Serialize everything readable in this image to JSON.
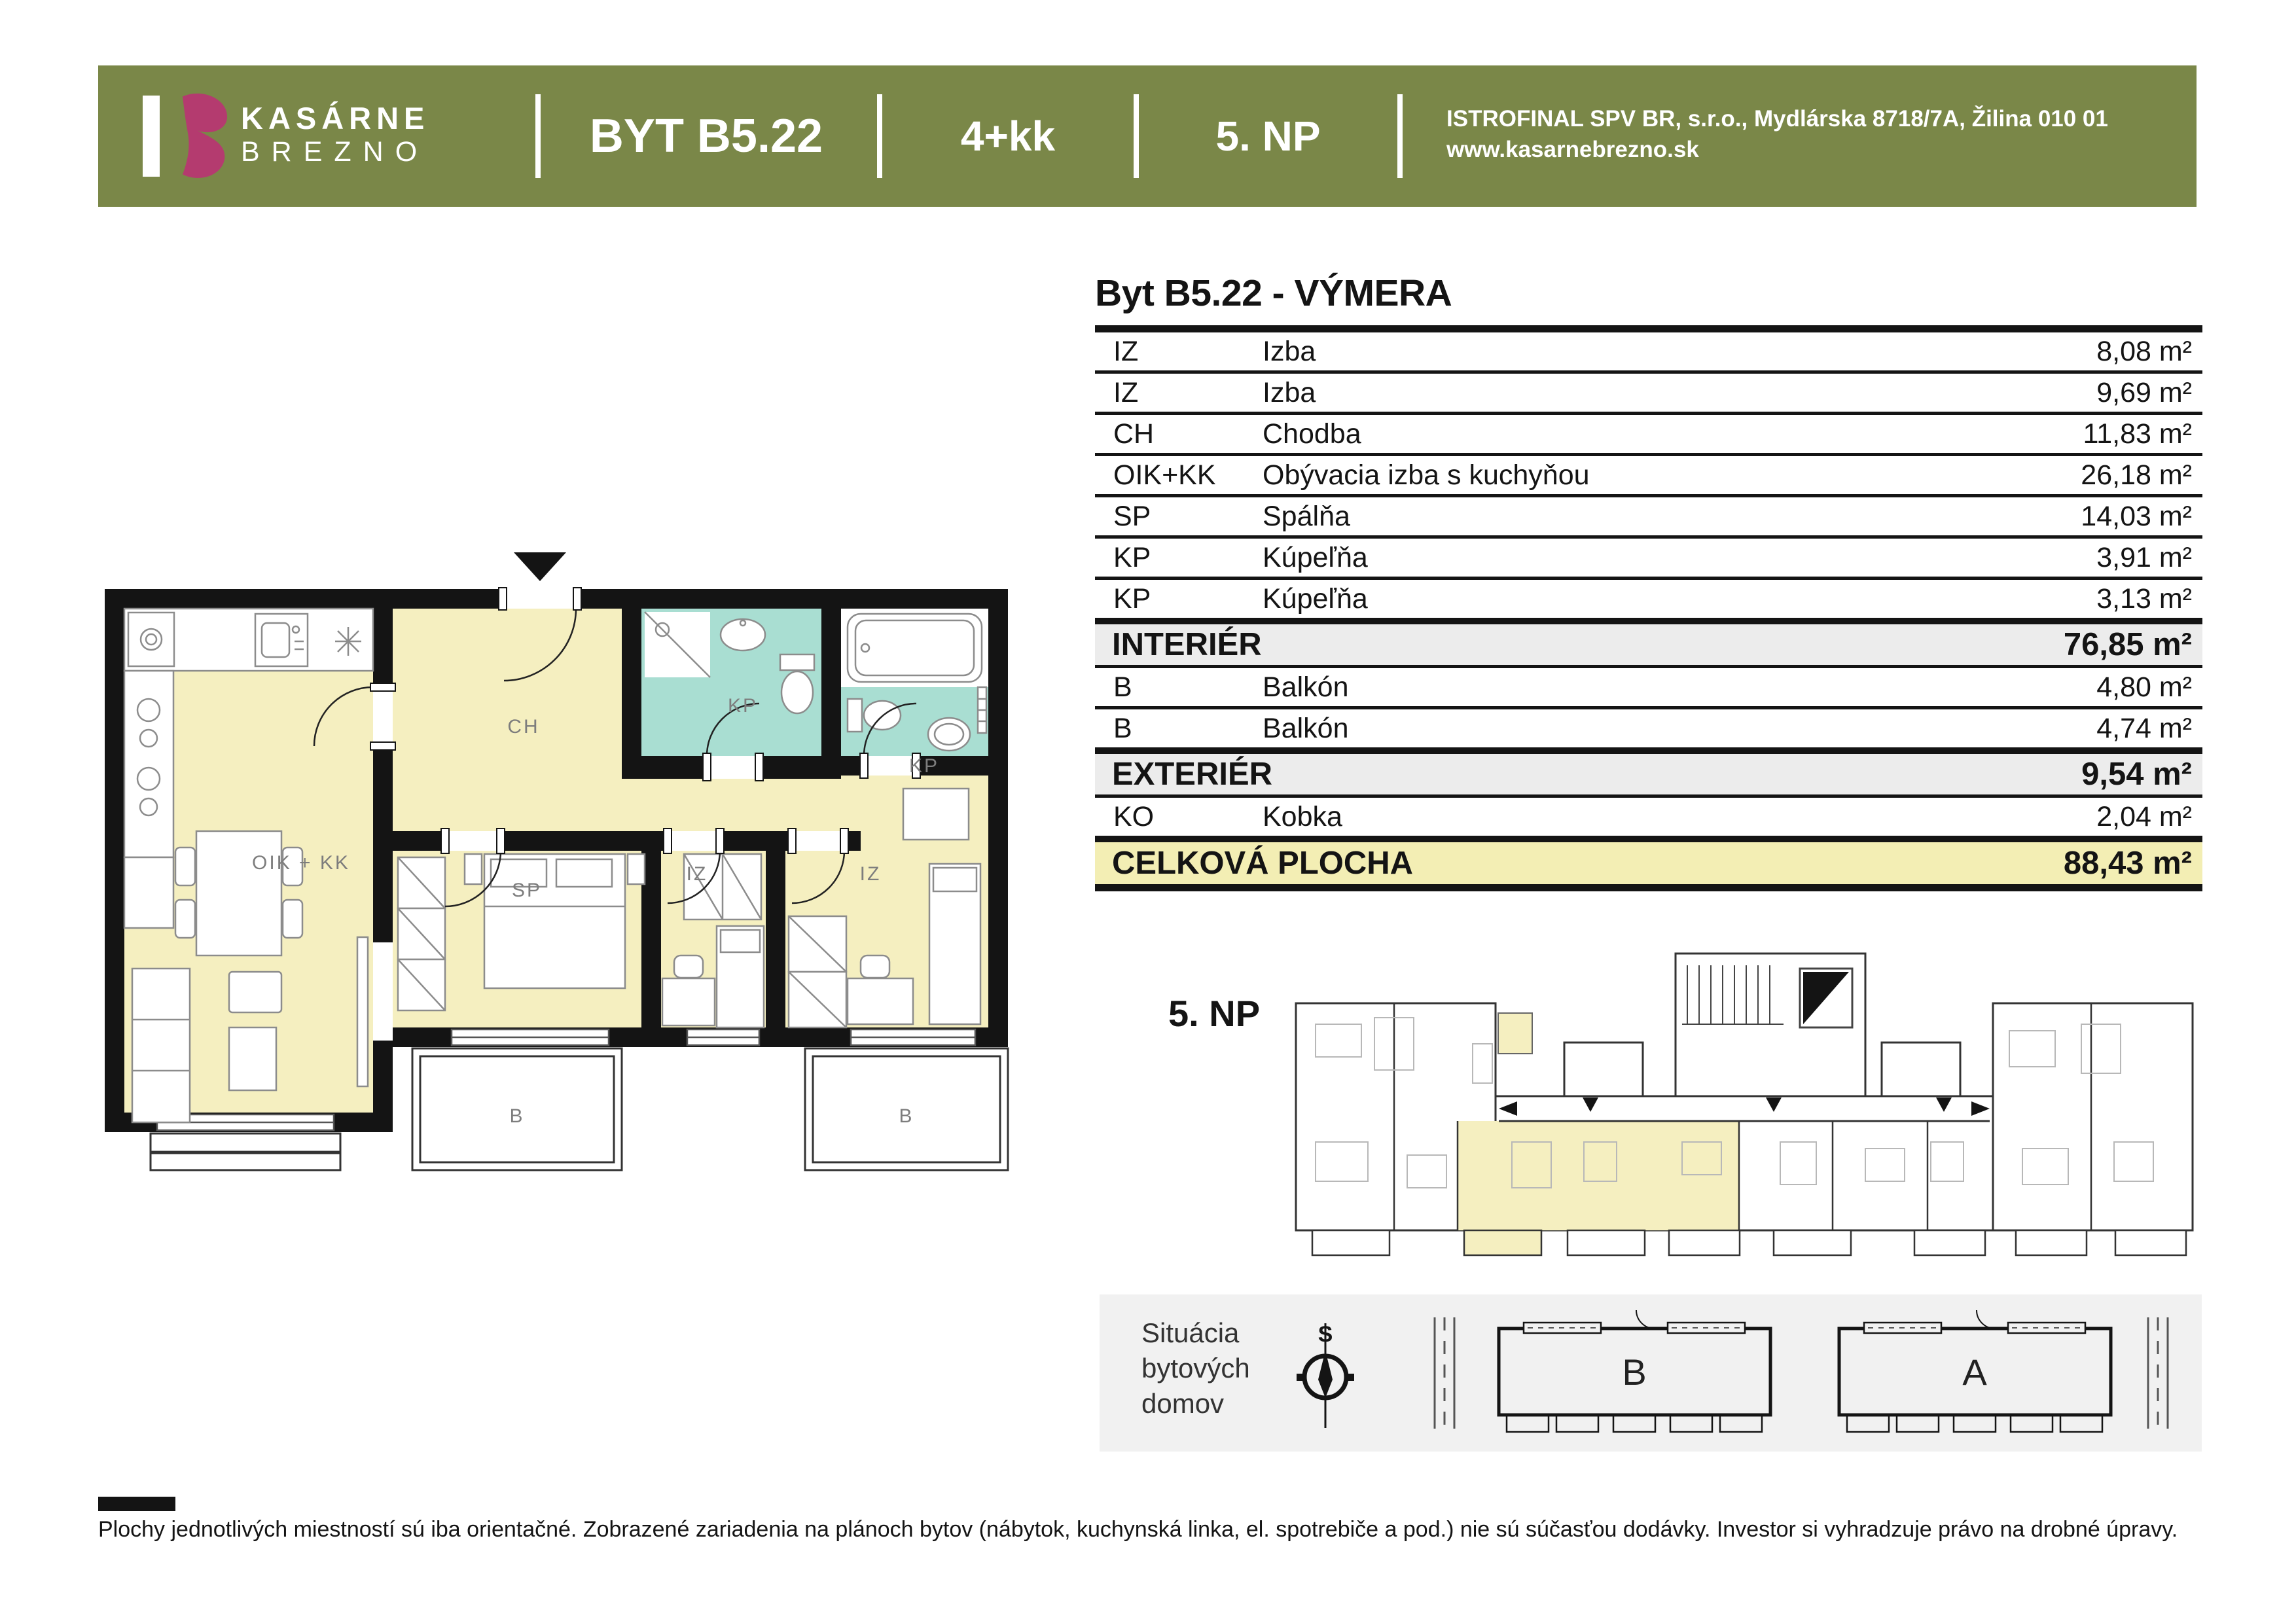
{
  "header": {
    "bar_color": "#7a8748",
    "logo": {
      "brand_top": "KASÁRNE",
      "brand_bottom": "BREZNO",
      "accent_color": "#b43b6f"
    },
    "apartment_id": "BYT B5.22",
    "layout_type": "4+kk",
    "floor": "5. NP",
    "company_address": "ISTROFINAL SPV BR, s.r.o., Mydlárska 8718/7A, Žilina 010 01",
    "company_website": "www.kasarnebrezno.sk"
  },
  "area_table": {
    "title": "Byt B5.22 - VÝMERA",
    "rows": [
      {
        "type": "item",
        "code": "IZ",
        "name": "Izba",
        "area": "8,08 m²"
      },
      {
        "type": "item",
        "code": "IZ",
        "name": "Izba",
        "area": "9,69 m²"
      },
      {
        "type": "item",
        "code": "CH",
        "name": "Chodba",
        "area": "11,83 m²"
      },
      {
        "type": "item",
        "code": "OIK+KK",
        "name": "Obývacia izba s kuchyňou",
        "area": "26,18 m²"
      },
      {
        "type": "item",
        "code": "SP",
        "name": "Spálňa",
        "area": "14,03 m²"
      },
      {
        "type": "item",
        "code": "KP",
        "name": "Kúpeľňa",
        "area": "3,91 m²"
      },
      {
        "type": "item",
        "code": "KP",
        "name": "Kúpeľňa",
        "area": "3,13 m²"
      },
      {
        "type": "subtotal",
        "name": "INTERIÉR",
        "area": "76,85 m²"
      },
      {
        "type": "item",
        "code": "B",
        "name": "Balkón",
        "area": "4,80 m²"
      },
      {
        "type": "item",
        "code": "B",
        "name": "Balkón",
        "area": "4,74 m²"
      },
      {
        "type": "subtotal",
        "name": "EXTERIÉR",
        "area": "9,54 m²"
      },
      {
        "type": "item",
        "code": "KO",
        "name": "Kobka",
        "area": "2,04 m²"
      },
      {
        "type": "total",
        "name": "CELKOVÁ PLOCHA",
        "area": "88,43 m²"
      }
    ]
  },
  "floor_plan": {
    "room_labels": [
      "OIK + KK",
      "CH",
      "SP",
      "IZ",
      "IZ",
      "KP",
      "KP"
    ],
    "balcony_labels": [
      "B",
      "B"
    ],
    "colors": {
      "room_fill": "#f5efc0",
      "bath_fill": "#a9ded2",
      "wall": "#141414"
    }
  },
  "overview": {
    "floor_label": "5. NP",
    "highlight_color": "#f5efc0"
  },
  "situation": {
    "title_line1": "Situácia",
    "title_line2": "bytových",
    "title_line3": "domov",
    "compass_letter": "S",
    "building_left": "B",
    "building_right": "A"
  },
  "footer": {
    "disclaimer": "Plochy jednotlivých miestností sú iba orientačné. Zobrazené zariadenia na plánoch bytov (nábytok, kuchynská linka, el. spotrebiče a pod.) nie sú súčasťou dodávky. Investor si vyhradzuje právo na drobné úpravy."
  }
}
